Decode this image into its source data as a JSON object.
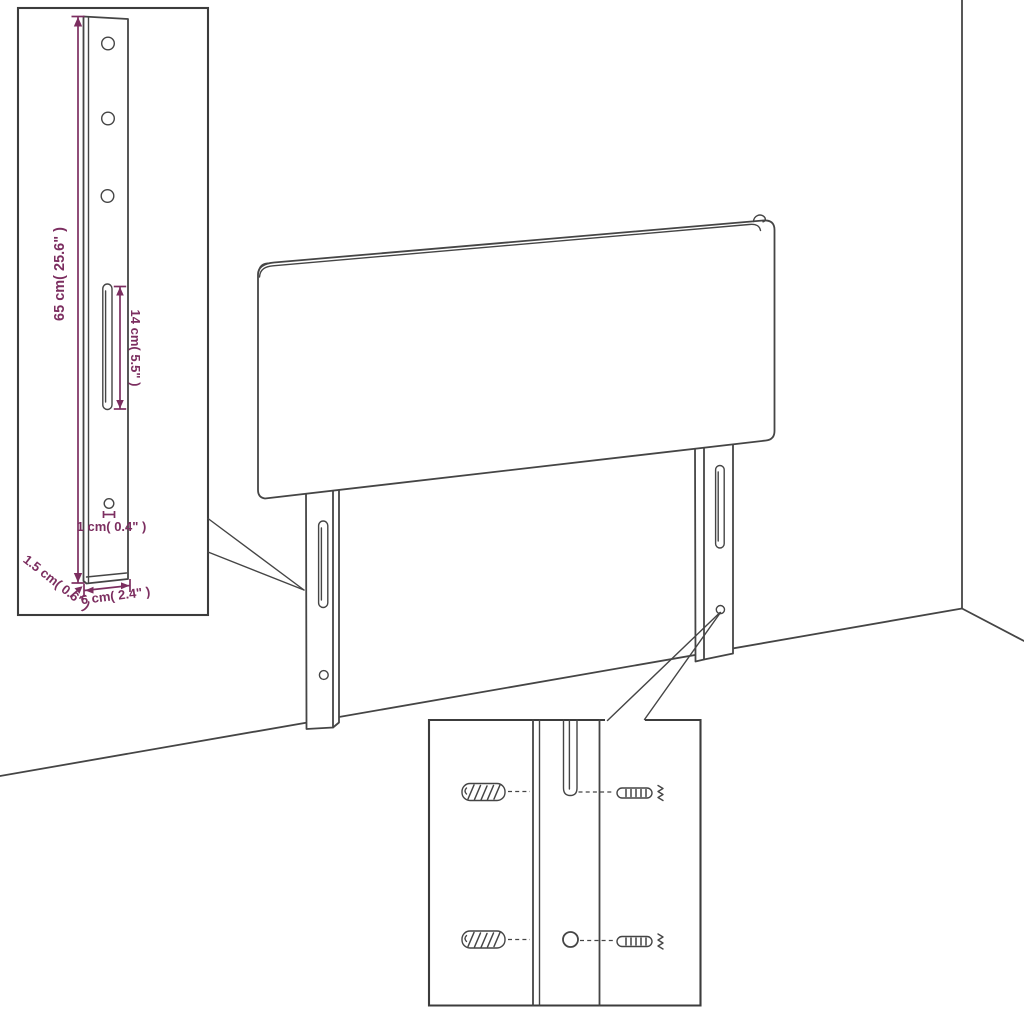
{
  "canvas": {
    "width": 1024,
    "height": 1024,
    "background": "#ffffff"
  },
  "colors": {
    "outline": "#454545",
    "detail_box_border": "#3c3c3c",
    "dimension_accent": "#7c2e60"
  },
  "dimensions": {
    "bracket_height": "65 cm( 25.6\" )",
    "slot_length": "14 cm( 5.5\" )",
    "hole_diameter": "1 cm( 0.4\" )",
    "bracket_thickness": "1.5 cm( 0.6\" )",
    "bracket_width": "6 cm( 2.4\" )"
  }
}
